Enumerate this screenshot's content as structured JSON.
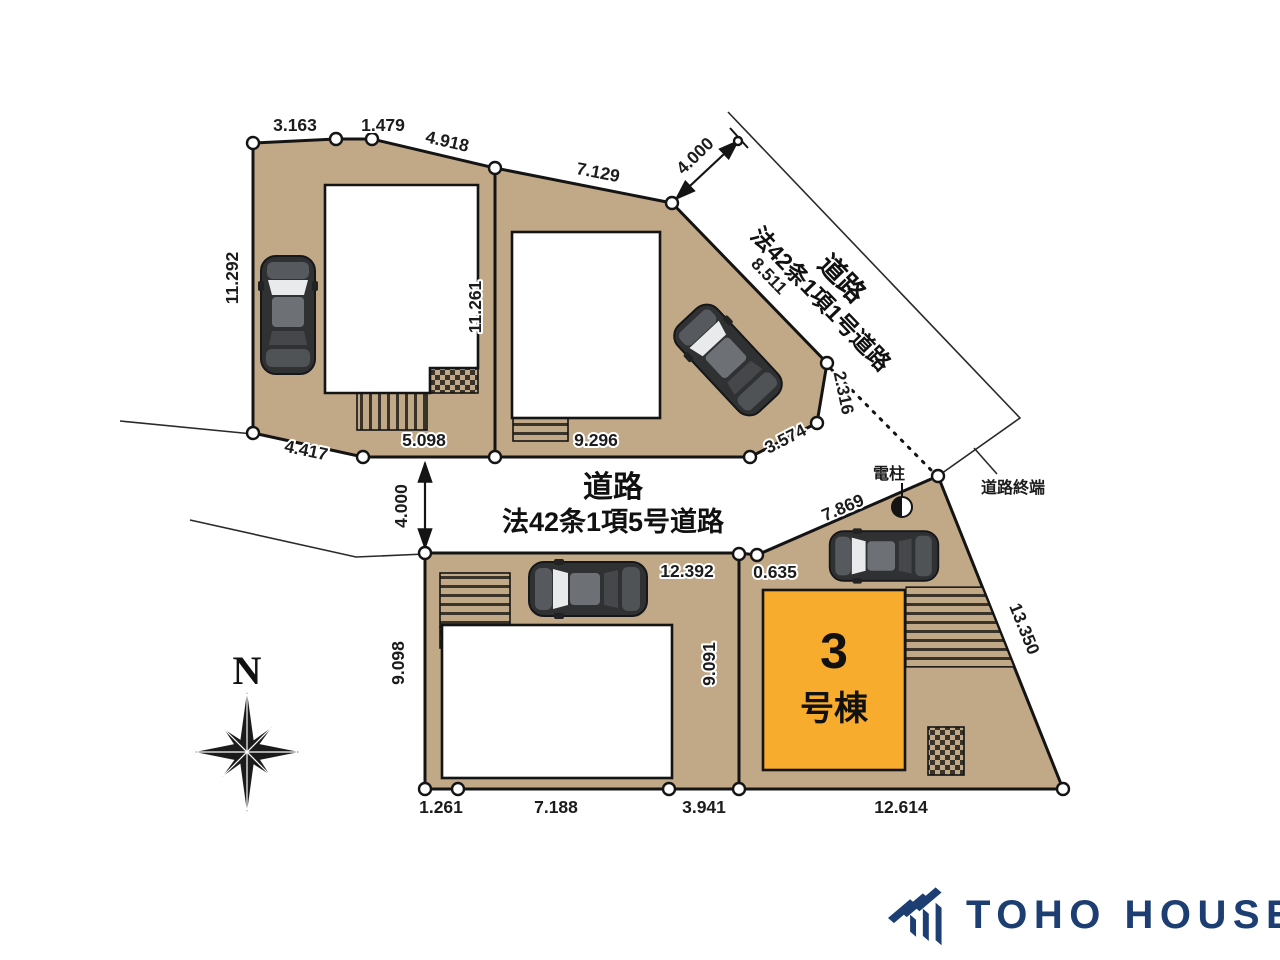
{
  "labels": {
    "north": "N",
    "road1_line1": "道路",
    "road1_line2": "法42条1項1号道路",
    "road2_line1": "道路",
    "road2_line2": "法42条1項5号道路",
    "road_end": "道路終端",
    "utility_pole": "電柱",
    "building3_number": "3",
    "building3_suffix": "号棟"
  },
  "dimensions": {
    "lot1_top_a": "3.163",
    "lot1_top_b": "1.479",
    "lot1_top_c": "4.918",
    "lot2_top": "7.129",
    "road1_width": "4.000",
    "lot1_left": "11.292",
    "lot1_lot2_boundary": "11.261",
    "lot2_road_edge": "8.511",
    "lot1_bottom_diag": "4.417",
    "lot1_bottom": "5.098",
    "lot2_bottom": "9.296",
    "lot2_corner_a": "2.316",
    "lot2_corner_b": "3.574",
    "road2_width": "4.000",
    "lot4_top": "12.392",
    "lot3_top_small": "0.635",
    "lot3_top_diag": "7.869",
    "lot3_right": "13.350",
    "lot4_left": "9.098",
    "lot3_left": "9.091",
    "lot4_bottom_a": "1.261",
    "lot4_bottom_b": "7.188",
    "lot4_bottom_c": "3.941",
    "lot3_bottom": "12.614"
  },
  "colors": {
    "lot_fill": "#C1A887",
    "building3_fill": "#F7AC2E",
    "brand_navy": "#1D3E73"
  },
  "footer": {
    "brand": "TOHO HOUSE"
  }
}
